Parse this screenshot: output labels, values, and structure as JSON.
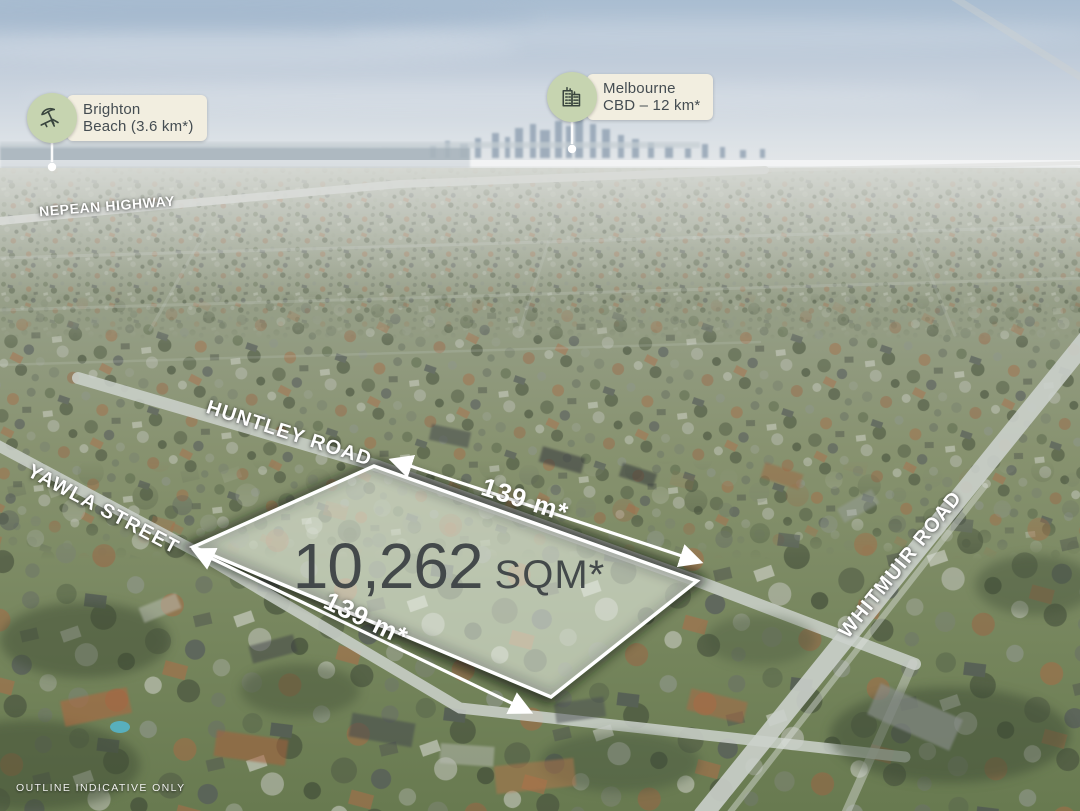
{
  "callouts": {
    "brighton": {
      "title": "Brighton",
      "subtitle": "Beach (3.6 km*)",
      "icon": "beach-umbrella-icon"
    },
    "melbourne": {
      "title": "Melbourne",
      "subtitle": "CBD – 12 km*",
      "icon": "city-buildings-icon"
    }
  },
  "road_labels": {
    "nepean": "NEPEAN HIGHWAY",
    "huntley": "HUNTLEY ROAD",
    "yawla": "YAWLA STREET",
    "whitmuir": "WHITMUIR ROAD"
  },
  "parcel": {
    "area_value": "10,262",
    "area_unit": "SQM*",
    "frontage_top": "139 m*",
    "frontage_side": "139 m*"
  },
  "disclaimer": "OUTLINE INDICATIVE ONLY",
  "colors": {
    "callout_background": "#f2eee0",
    "callout_icon_circle": "#c6d4b0",
    "callout_text": "#454d52",
    "area_text": "#3a3f43",
    "road_label_text": "#ffffff",
    "parcel_outline": "#ffffff"
  }
}
